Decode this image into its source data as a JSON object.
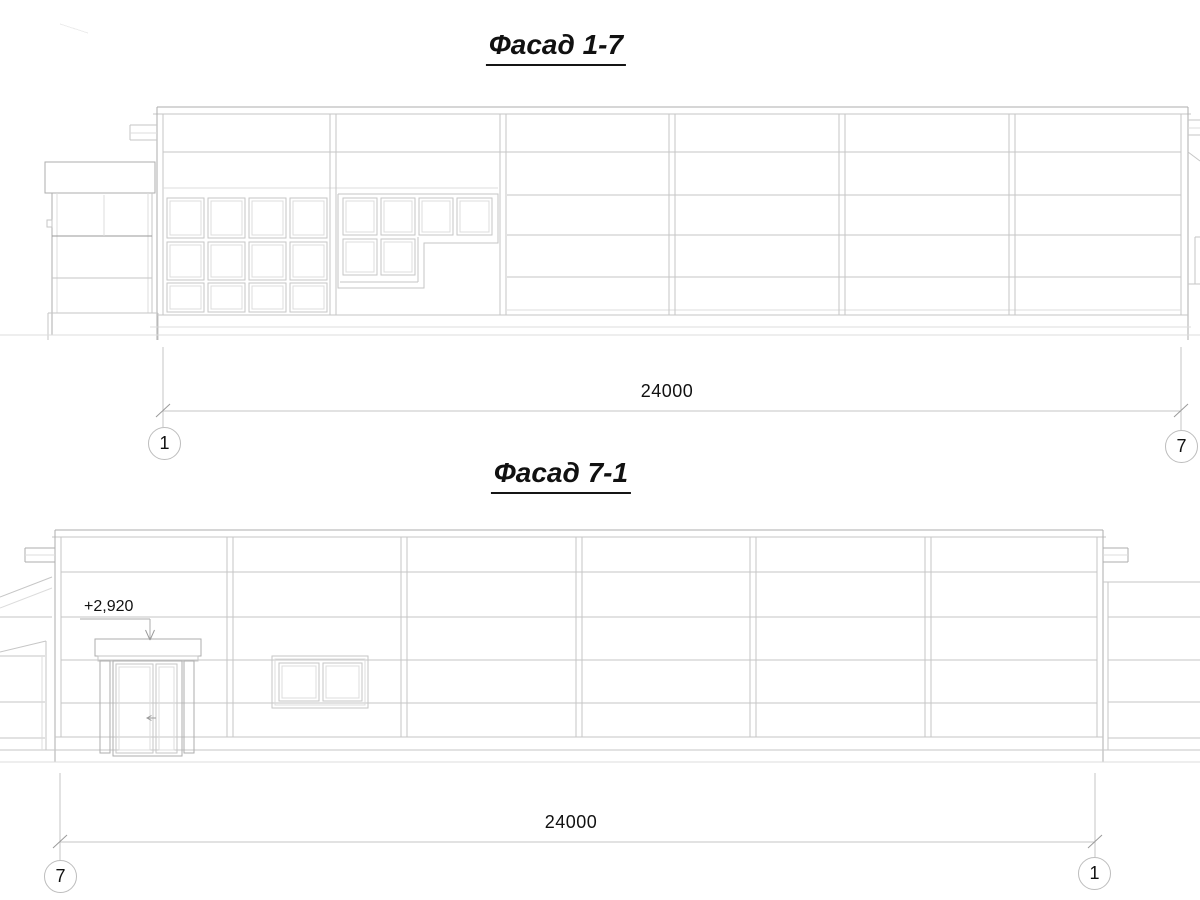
{
  "sheet": {
    "background": "#ffffff",
    "line_color_light": "#c6c6c6",
    "line_color_dark": "#aeaeae",
    "ground_line_color": "#161616",
    "text_color": "#111111"
  },
  "facade_top": {
    "title": "Фасад 1-7",
    "dimension_label": "24000",
    "axis_left_label": "1",
    "axis_right_label": "7"
  },
  "facade_bottom": {
    "title": "Фасад 7-1",
    "dimension_label": "24000",
    "axis_left_label": "7",
    "axis_right_label": "1",
    "elevation_label": "+2,920"
  }
}
